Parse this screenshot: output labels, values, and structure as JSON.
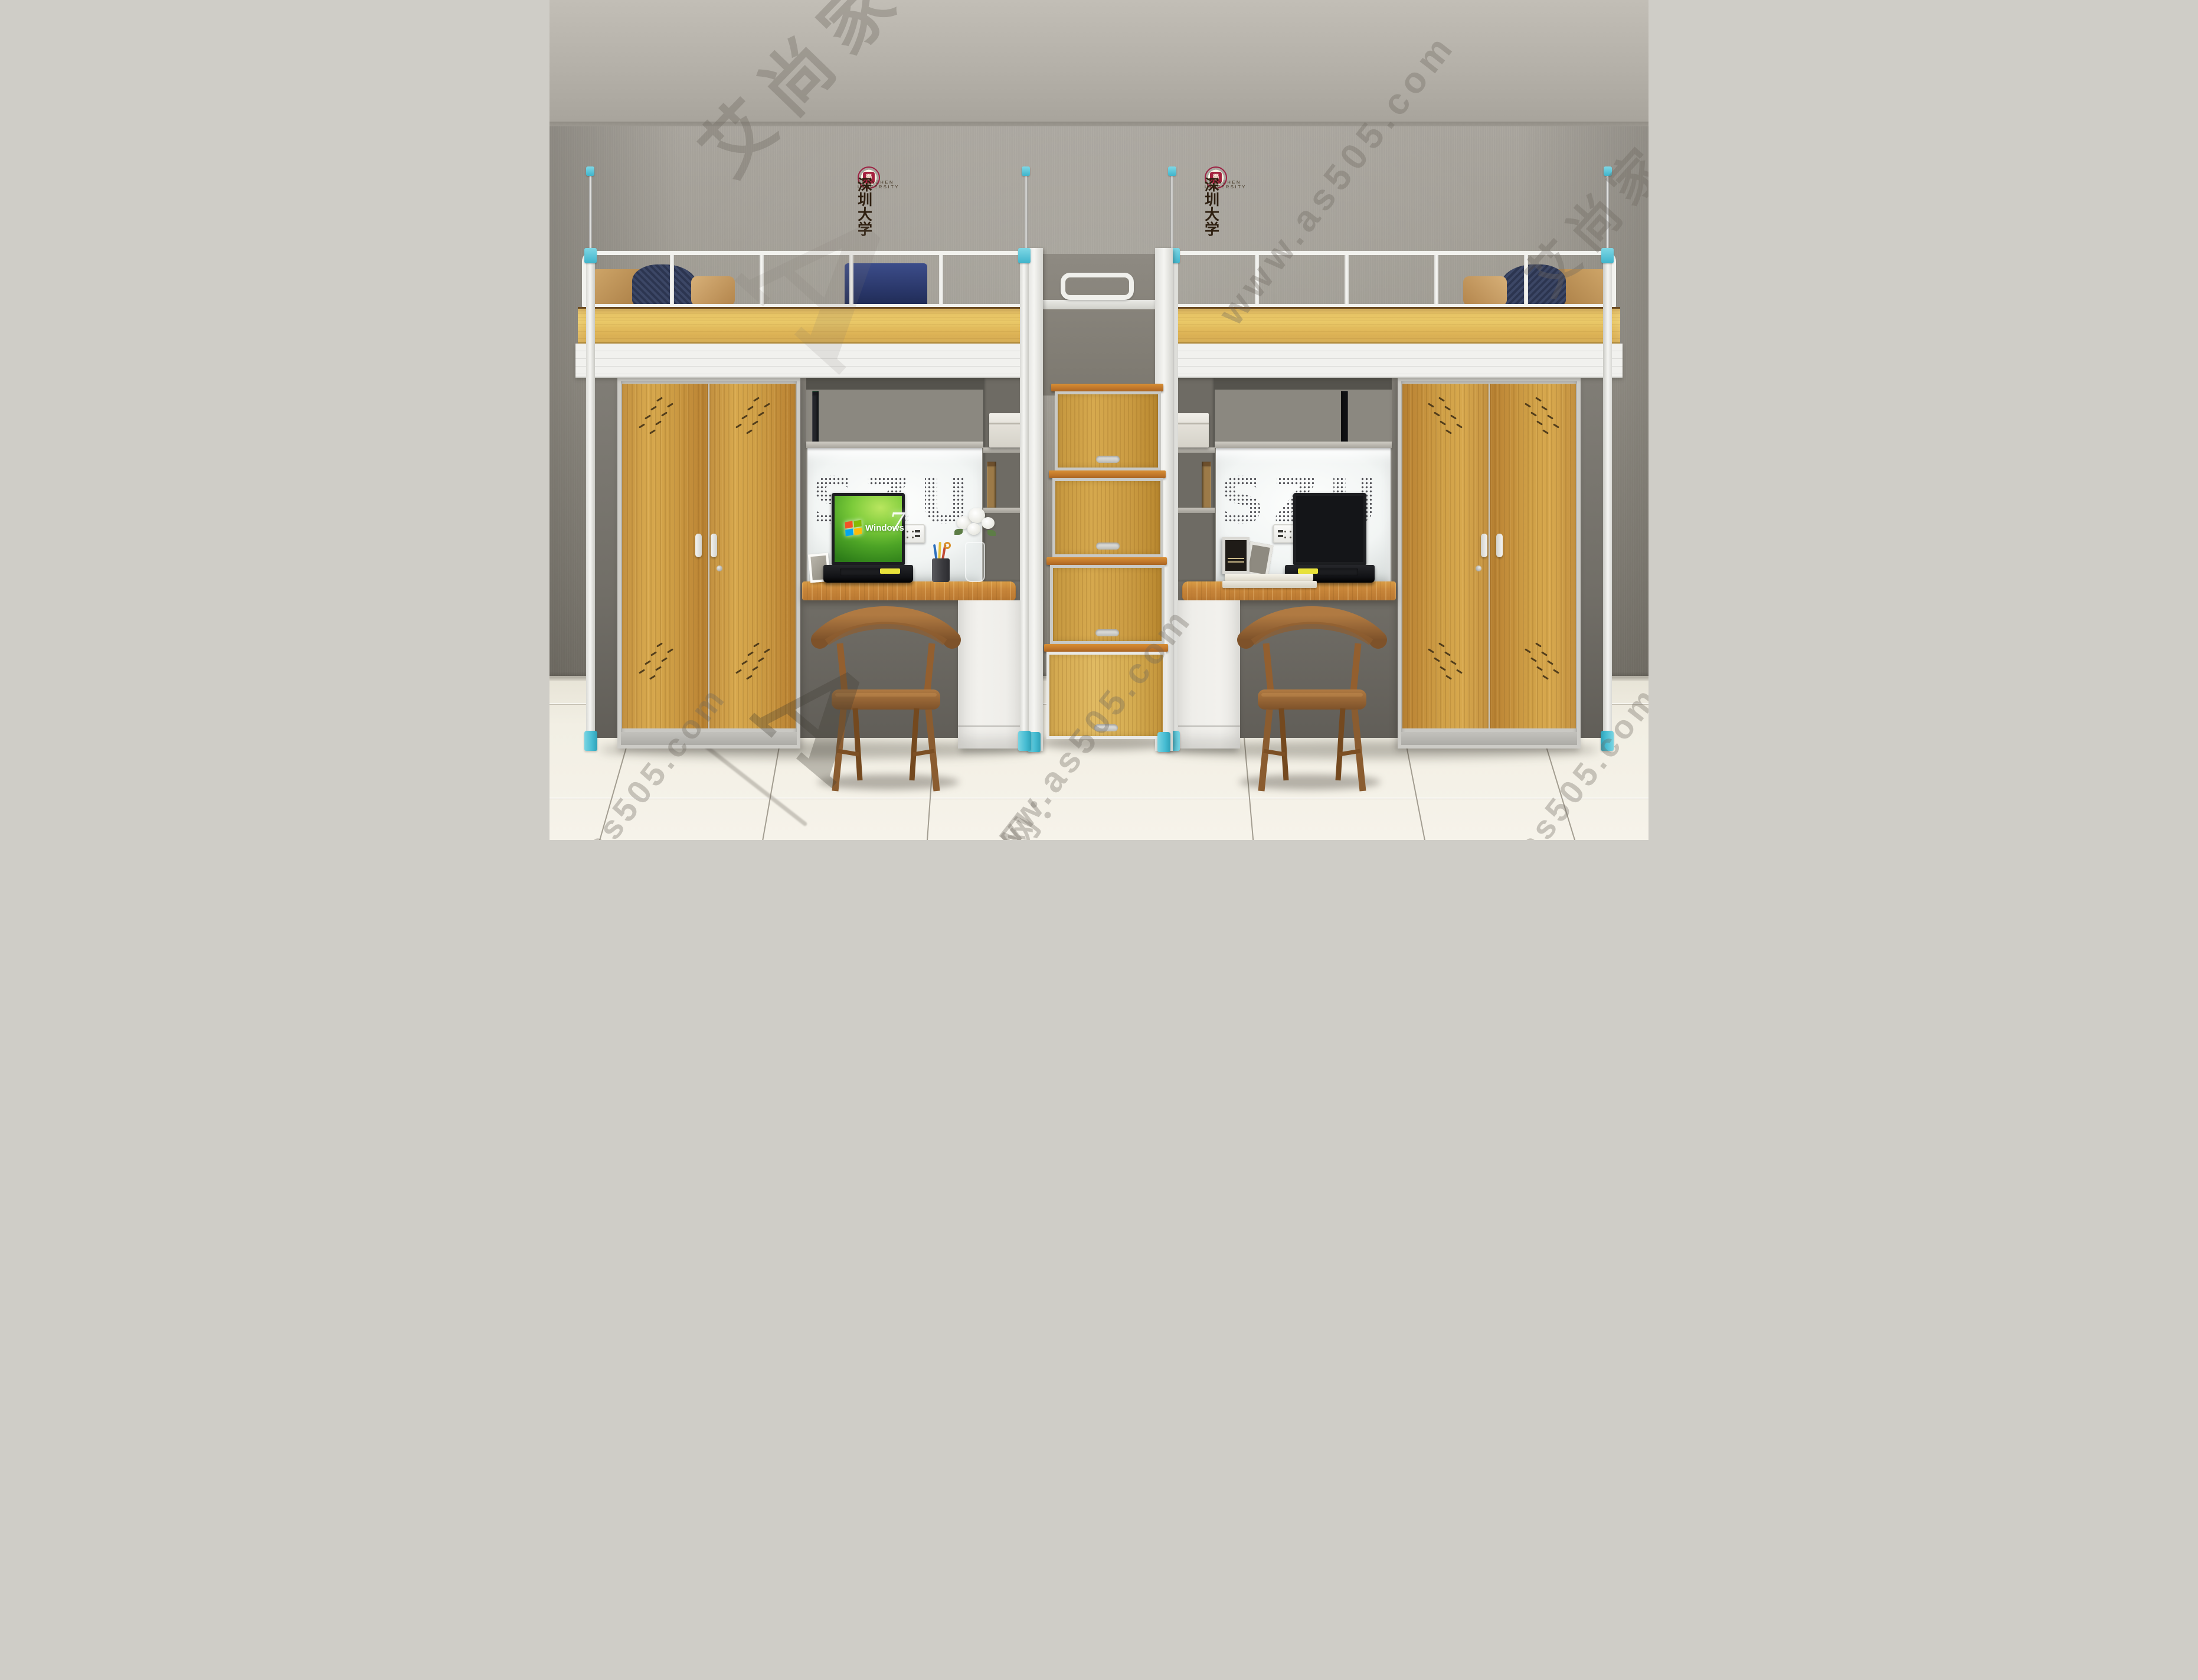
{
  "watermarks": {
    "brand": "艾尚家具",
    "logo_letter": "A",
    "url": "www.as505.com",
    "site_prefix": "官网：",
    "domain_fragment": "as505.com"
  },
  "university": {
    "name_zh": "深圳大学",
    "name_en": "SHENZHEN UNIVERSITY",
    "seal_glyph": "學"
  },
  "back_panel": {
    "letters": "SZU"
  },
  "laptop": {
    "os_name": "Windows",
    "os_version": "7"
  },
  "colors": {
    "accent_cyan": "#48bdd2",
    "wood_panel": "#e0ba5a",
    "wood_door": "#cf9f46",
    "wood_desk": "#c8863a",
    "frame_white": "#f2f2ee",
    "floor_tile": "#f2efe4"
  },
  "books": {
    "visible_titles": [
      "NEW YORK CITY",
      "WAR",
      "HOW to BUY a HOUSE FOR 15",
      "Exile and the Kingdom",
      "JOYDIVISION",
      "YOUNG THE STACK",
      "RECIPES BY"
    ],
    "left": [
      {
        "c": "#b23b43",
        "h": 80,
        "w": 10
      },
      {
        "c": "#cfe3da",
        "h": 78,
        "w": 12
      },
      {
        "c": "#2a2a2e",
        "h": 76,
        "w": 10
      },
      {
        "c": "#a8693a",
        "h": 74,
        "w": 9
      },
      {
        "c": "#23252a",
        "h": 82,
        "w": 8
      },
      {
        "c": "#3f9e8f",
        "h": 72,
        "w": 10
      },
      {
        "c": "#2f8f6e",
        "h": 70,
        "w": 9
      },
      {
        "c": "#efe7d6",
        "h": 68,
        "w": 8
      },
      {
        "c": "#e2892f",
        "h": 70,
        "w": 9
      },
      {
        "c": "#f0c93c",
        "h": 68,
        "w": 8
      },
      {
        "c": "#3a68b0",
        "h": 71,
        "w": 8
      },
      {
        "c": "#d94b35",
        "h": 84,
        "w": 10
      },
      {
        "c": "#1d4d3b",
        "h": 78,
        "w": 9
      },
      {
        "c": "#c33e31",
        "h": 82,
        "w": 11
      },
      {
        "c": "#e8dfc8",
        "h": 72,
        "w": 8
      },
      {
        "c": "#d97b23",
        "h": 80,
        "w": 10
      },
      {
        "c": "#efc83a",
        "h": 76,
        "w": 9
      },
      {
        "c": "#2b6cb5",
        "h": 74,
        "w": 8
      },
      {
        "c": "#20304d",
        "h": 80,
        "w": 9
      },
      {
        "c": "#c0392f",
        "h": 68,
        "w": 8
      },
      {
        "c": "#15161a",
        "h": 76,
        "w": 10
      },
      {
        "c": "#1f3b2c",
        "h": 86,
        "w": 11
      },
      {
        "c": "#6d2136",
        "h": 78,
        "w": 10
      },
      {
        "c": "#8a4d8f",
        "h": 70,
        "w": 8
      },
      {
        "c": "#b8302e",
        "h": 82,
        "w": 10
      },
      {
        "c": "#5d6b2f",
        "h": 74,
        "w": 9
      },
      {
        "c": "#c9a96d",
        "h": 80,
        "w": 10
      },
      {
        "c": "#191a1e",
        "h": 84,
        "w": 11
      },
      {
        "c": "#7d1f28",
        "h": 76,
        "w": 9
      },
      {
        "c": "#30503e",
        "h": 68,
        "w": 8
      },
      {
        "c": "#d3c9b2",
        "h": 72,
        "w": 8
      },
      {
        "c": "#23252a",
        "h": 78,
        "w": 9
      }
    ],
    "right": [
      {
        "c": "#e9e4d6",
        "h": 76,
        "w": 10
      },
      {
        "c": "#14161a",
        "h": 78,
        "w": 11
      },
      {
        "c": "#e86a2a",
        "h": 74,
        "w": 9
      },
      {
        "c": "#f2efe7",
        "h": 72,
        "w": 8
      },
      {
        "c": "#d8d2c2",
        "h": 80,
        "w": 10
      },
      {
        "c": "#101114",
        "h": 82,
        "w": 12
      },
      {
        "c": "#1a1b1f",
        "h": 86,
        "w": 12
      },
      {
        "c": "#c03228",
        "h": 78,
        "w": 10
      },
      {
        "c": "#101114",
        "h": 74,
        "w": 9
      },
      {
        "c": "#ece8dd",
        "h": 70,
        "w": 8
      },
      {
        "c": "#e5b8b4",
        "h": 76,
        "w": 9
      },
      {
        "c": "#0f1013",
        "h": 84,
        "w": 11
      }
    ],
    "right_stack": [
      "#efe9da",
      "#1c1d22",
      "#f4f1e8",
      "#caccc8"
    ],
    "old": [
      {
        "c": "#8a6a3e",
        "h": 74,
        "w": 16
      },
      {
        "c": "#6d4f2c",
        "h": 78,
        "w": 16
      },
      {
        "c": "#9c7a48",
        "h": 70,
        "w": 15
      }
    ]
  }
}
